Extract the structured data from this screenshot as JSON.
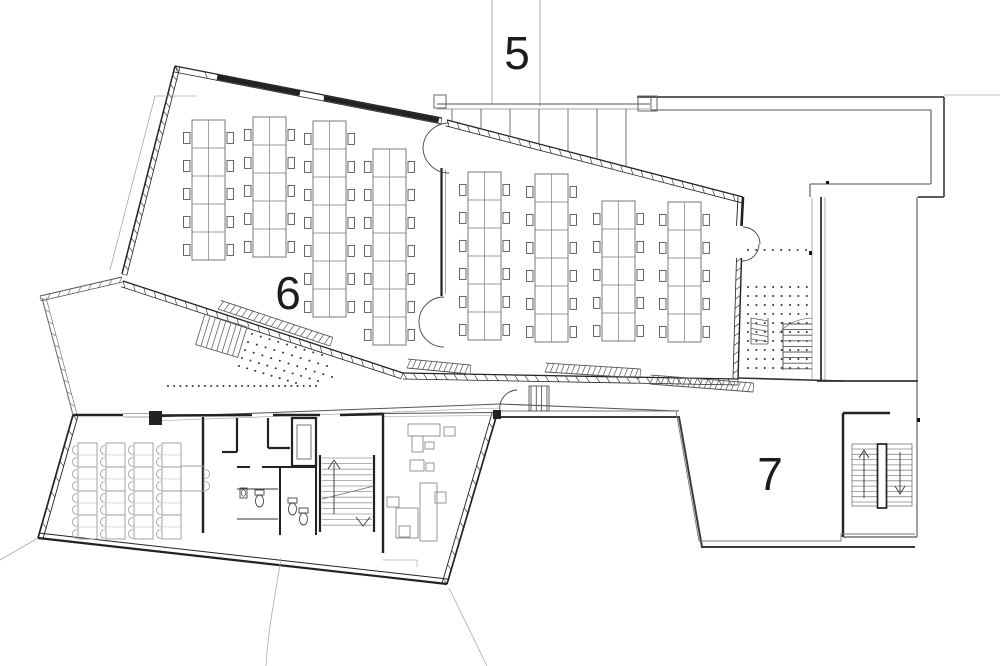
{
  "title": "floor-plan-level",
  "labels": {
    "area_5": "5",
    "area_6": "6",
    "area_7": "7"
  },
  "palette": {
    "ink": "#222222",
    "mid": "#555555",
    "light": "#999999",
    "furniture": "#7a7a7a",
    "faint": "#aaaaaa",
    "bg": "#ffffff"
  },
  "plan": {
    "grid_lines": [
      {
        "x1": 492,
        "y1": 0,
        "x2": 492,
        "y2": 104,
        "w": 0.8,
        "c": "#999999"
      },
      {
        "x1": 540,
        "y1": 0,
        "x2": 540,
        "y2": 107,
        "w": 0.8,
        "c": "#999999"
      }
    ],
    "walls": [
      {
        "x1": 175,
        "y1": 66,
        "x2": 122,
        "y2": 274,
        "off": 5,
        "lw": 1.5,
        "lt": 0.8,
        "hatch": 24,
        "c": "#222222"
      },
      {
        "x1": 175,
        "y1": 66,
        "x2": 442,
        "y2": 118,
        "off": -6,
        "lw": 1.2,
        "lt": 0.8,
        "hatch": 10,
        "solid": [
          [
            0.16,
            0.47
          ],
          [
            0.56,
            0.99
          ]
        ],
        "c": "#222222"
      },
      {
        "x1": 447,
        "y1": 120,
        "x2": 743,
        "y2": 197,
        "off": -6,
        "lw": 1.3,
        "lt": 0.8,
        "hatch": 30,
        "c": "#222222"
      },
      {
        "x1": 743,
        "y1": 197,
        "x2": 741.5,
        "y2": 226,
        "off": -5,
        "lw": 2.6,
        "lt": 0.9,
        "hatch": 0,
        "c": "#222222"
      },
      {
        "x1": 741.5,
        "y1": 258,
        "x2": 738,
        "y2": 379,
        "off": -5,
        "lw": 1.4,
        "lt": 0.8,
        "hatch": 14,
        "c": "#222222"
      },
      {
        "x1": 123,
        "y1": 281,
        "x2": 403,
        "y2": 373,
        "off": -6,
        "lw": 1.3,
        "lt": 0.8,
        "hatch": 28,
        "c": "#222222"
      },
      {
        "x1": 403,
        "y1": 373,
        "x2": 738,
        "y2": 379,
        "off": -6,
        "lw": 1.3,
        "lt": 0.8,
        "hatch": 34,
        "c": "#222222"
      },
      {
        "x1": 122,
        "y1": 277,
        "x2": 40,
        "y2": 296,
        "off": 5,
        "lw": 1.1,
        "lt": 0.7,
        "hatch": 9,
        "c": "#555555"
      },
      {
        "x1": 42,
        "y1": 298,
        "x2": 73,
        "y2": 415,
        "off": 4,
        "lw": 1.0,
        "lt": 0.6,
        "hatch": 11,
        "c": "#666666"
      },
      {
        "x1": 73,
        "y1": 415,
        "x2": 38,
        "y2": 538,
        "off": 5,
        "lw": 1.7,
        "lt": 0.9,
        "hatch": 9,
        "c": "#222222"
      },
      {
        "x1": 38,
        "y1": 538,
        "x2": 447,
        "y2": 584,
        "off": 5,
        "lw": 2.2,
        "lt": 1.0,
        "hatch": 0,
        "c": "#222222"
      },
      {
        "x1": 447,
        "y1": 584,
        "x2": 497,
        "y2": 414,
        "off": 5,
        "lw": 1.7,
        "lt": 0.9,
        "hatch": 13,
        "c": "#222222"
      }
    ],
    "lines": [
      {
        "x1": 437,
        "y1": 104,
        "x2": 650,
        "y2": 104,
        "w": 1.1,
        "c": "#555555"
      },
      {
        "x1": 437,
        "y1": 109,
        "x2": 650,
        "y2": 109,
        "w": 0.7,
        "c": "#888888"
      },
      {
        "x1": 637,
        "y1": 97,
        "x2": 944,
        "y2": 97,
        "w": 1.7,
        "c": "#444444"
      },
      {
        "x1": 944,
        "y1": 97,
        "x2": 944,
        "y2": 197,
        "w": 1.7,
        "c": "#444444"
      },
      {
        "x1": 944,
        "y1": 197,
        "x2": 918,
        "y2": 197,
        "w": 1.7,
        "c": "#444444"
      },
      {
        "x1": 651,
        "y1": 110,
        "x2": 931,
        "y2": 110,
        "w": 1.1,
        "c": "#555555"
      },
      {
        "x1": 931,
        "y1": 110,
        "x2": 931,
        "y2": 184,
        "w": 1.1,
        "c": "#555555"
      },
      {
        "x1": 931,
        "y1": 184,
        "x2": 810,
        "y2": 184,
        "w": 1.1,
        "c": "#555555"
      },
      {
        "x1": 810,
        "y1": 184,
        "x2": 810,
        "y2": 197,
        "w": 1.1,
        "c": "#555555"
      },
      {
        "x1": 651,
        "y1": 97,
        "x2": 651,
        "y2": 110,
        "w": 1.0,
        "c": "#666666"
      },
      {
        "x1": 944,
        "y1": 95,
        "x2": 1000,
        "y2": 95,
        "w": 0.8,
        "c": "#aaaaaa"
      },
      {
        "x1": 821,
        "y1": 197,
        "x2": 821,
        "y2": 381,
        "w": 1.8,
        "c": "#333333"
      },
      {
        "x1": 825,
        "y1": 197,
        "x2": 825,
        "y2": 381,
        "w": 0.7,
        "c": "#888888"
      },
      {
        "x1": 917,
        "y1": 197,
        "x2": 917,
        "y2": 537,
        "w": 1.1,
        "c": "#555555"
      },
      {
        "x1": 817,
        "y1": 381,
        "x2": 918,
        "y2": 381,
        "w": 1.8,
        "c": "#333333"
      },
      {
        "x1": 812,
        "y1": 198,
        "x2": 812,
        "y2": 379,
        "w": 0.8,
        "c": "#999999"
      },
      {
        "x1": 738,
        "y1": 378,
        "x2": 843,
        "y2": 381,
        "w": 1.6,
        "c": "#333333"
      },
      {
        "x1": 152,
        "y1": 417,
        "x2": 500,
        "y2": 404,
        "w": 1.0,
        "c": "#555555"
      },
      {
        "x1": 152,
        "y1": 421,
        "x2": 500,
        "y2": 408,
        "w": 0.6,
        "c": "#999999"
      },
      {
        "x1": 500,
        "y1": 404,
        "x2": 679,
        "y2": 411,
        "w": 1.0,
        "c": "#555555"
      },
      {
        "x1": 155,
        "y1": 96,
        "x2": 197,
        "y2": 96,
        "w": 0.8,
        "c": "#aaaaaa"
      },
      {
        "x1": 155,
        "y1": 96,
        "x2": 110,
        "y2": 270,
        "w": 0.8,
        "c": "#aaaaaa"
      },
      {
        "x1": 38,
        "y1": 538,
        "x2": 0,
        "y2": 560,
        "w": 0.8,
        "c": "#aaaaaa"
      },
      {
        "x1": 449,
        "y1": 588,
        "x2": 487,
        "y2": 666,
        "w": 0.8,
        "c": "#aaaaaa"
      },
      {
        "x1": 441.5,
        "y1": 168,
        "x2": 441.5,
        "y2": 296,
        "w": 2.2,
        "c": "#222222"
      },
      {
        "x1": 445.5,
        "y1": 170,
        "x2": 445.5,
        "y2": 294,
        "w": 0.8,
        "c": "#888888"
      },
      {
        "x1": 73,
        "y1": 415,
        "x2": 123,
        "y2": 415,
        "w": 2.6,
        "c": "#222222"
      },
      {
        "x1": 123,
        "y1": 413.5,
        "x2": 152,
        "y2": 413.5,
        "w": 0.7,
        "c": "#888888"
      },
      {
        "x1": 123,
        "y1": 417,
        "x2": 152,
        "y2": 417,
        "w": 0.7,
        "c": "#888888"
      },
      {
        "x1": 162,
        "y1": 415.5,
        "x2": 252,
        "y2": 415,
        "w": 2.6,
        "c": "#222222"
      },
      {
        "x1": 273,
        "y1": 415,
        "x2": 320,
        "y2": 415,
        "w": 2.6,
        "c": "#222222"
      },
      {
        "x1": 340,
        "y1": 415,
        "x2": 383,
        "y2": 414,
        "w": 2.6,
        "c": "#222222"
      },
      {
        "x1": 383,
        "y1": 413.5,
        "x2": 497,
        "y2": 412.5,
        "w": 0.9,
        "c": "#555555"
      },
      {
        "x1": 383,
        "y1": 416.5,
        "x2": 497,
        "y2": 415.5,
        "w": 0.6,
        "c": "#999999"
      },
      {
        "x1": 203,
        "y1": 417,
        "x2": 203,
        "y2": 533,
        "w": 2.4,
        "c": "#222222"
      },
      {
        "x1": 237,
        "y1": 418,
        "x2": 237,
        "y2": 452,
        "w": 2.2,
        "c": "#222222"
      },
      {
        "x1": 222,
        "y1": 452,
        "x2": 237,
        "y2": 452,
        "w": 2.2,
        "c": "#222222"
      },
      {
        "x1": 268,
        "y1": 418,
        "x2": 268,
        "y2": 448,
        "w": 2.2,
        "c": "#222222"
      },
      {
        "x1": 268,
        "y1": 448,
        "x2": 290,
        "y2": 448,
        "w": 2.2,
        "c": "#222222"
      },
      {
        "x1": 280,
        "y1": 467,
        "x2": 280,
        "y2": 535,
        "w": 2.0,
        "c": "#222222"
      },
      {
        "x1": 316,
        "y1": 467,
        "x2": 316,
        "y2": 535,
        "w": 2.0,
        "c": "#222222"
      },
      {
        "x1": 237,
        "y1": 467,
        "x2": 250,
        "y2": 467,
        "w": 2.0,
        "c": "#222222"
      },
      {
        "x1": 262,
        "y1": 467,
        "x2": 316,
        "y2": 467,
        "w": 2.0,
        "c": "#222222"
      },
      {
        "x1": 237,
        "y1": 489,
        "x2": 278,
        "y2": 489,
        "w": 1.1,
        "c": "#333333"
      },
      {
        "x1": 237,
        "y1": 519,
        "x2": 278,
        "y2": 519,
        "w": 1.1,
        "c": "#333333"
      },
      {
        "x1": 383,
        "y1": 413,
        "x2": 383,
        "y2": 553,
        "w": 2.4,
        "c": "#222222"
      },
      {
        "x1": 843,
        "y1": 413,
        "x2": 890,
        "y2": 413,
        "w": 2.4,
        "c": "#222222"
      },
      {
        "x1": 843,
        "y1": 413,
        "x2": 843,
        "y2": 537,
        "w": 2.4,
        "c": "#222222"
      },
      {
        "x1": 843,
        "y1": 537,
        "x2": 917,
        "y2": 537,
        "w": 1.2,
        "c": "#555555"
      },
      {
        "x1": 320,
        "y1": 455,
        "x2": 320,
        "y2": 532,
        "w": 2.2,
        "c": "#222222"
      },
      {
        "x1": 374,
        "y1": 455,
        "x2": 374,
        "y2": 532,
        "w": 2.2,
        "c": "#222222"
      },
      {
        "x1": 322,
        "y1": 499,
        "x2": 374,
        "y2": 486,
        "w": 0.8,
        "c": "#666666"
      },
      {
        "x1": 383,
        "y1": 560,
        "x2": 417,
        "y2": 560,
        "w": 0.7,
        "c": "#aaaaaa"
      },
      {
        "x1": 417,
        "y1": 560,
        "x2": 417,
        "y2": 567,
        "w": 0.7,
        "c": "#aaaaaa"
      }
    ],
    "paths": [
      {
        "d": "M 449,123 A 26 26 0 0 0 423,149",
        "w": 0.9,
        "c": "#444444"
      },
      {
        "d": "M 449,173 A 26 26 0 0 1 423,147",
        "w": 0.9,
        "c": "#444444"
      },
      {
        "d": "M 444,297 A 25 25 0 0 0 419,322",
        "w": 0.9,
        "c": "#444444"
      },
      {
        "d": "M 444,347 A 25 25 0 0 1 419,322",
        "w": 0.9,
        "c": "#444444"
      },
      {
        "d": "M 743,227 A 17 17 0 0 1 760,244",
        "w": 0.9,
        "c": "#444444"
      },
      {
        "d": "M 742,261 A 17 17 0 0 0 759,244",
        "w": 0.9,
        "c": "#444444"
      },
      {
        "d": "M 517,390 A 18 18 0 0 0 500,411",
        "w": 0.9,
        "c": "#444444"
      },
      {
        "d": "M 281,558 C 276,592 268,628 266,666",
        "w": 0.8,
        "c": "#aaaaaa"
      },
      {
        "d": "M 812,318 Q 791,319 779,333",
        "w": 0.8,
        "c": "#777777"
      }
    ],
    "rects": [
      {
        "x": 434,
        "y": 95,
        "w": 12,
        "h": 13,
        "lw": 1.0,
        "c": "#666666"
      },
      {
        "x": 638,
        "y": 96,
        "w": 19,
        "h": 15,
        "lw": 1.0,
        "c": "#666666"
      },
      {
        "x": 292,
        "y": 418,
        "w": 24,
        "h": 48,
        "lw": 2.2,
        "c": "#222222"
      },
      {
        "x": 297,
        "y": 425,
        "w": 14,
        "h": 34,
        "lw": 0.9,
        "c": "#666666"
      },
      {
        "x": 852,
        "y": 444,
        "w": 60,
        "h": 62,
        "lw": 0.8,
        "c": "#777777"
      },
      {
        "x": 877.5,
        "y": 444,
        "w": 9,
        "h": 64,
        "lw": 1.7,
        "c": "#222222",
        "fill": "#ffffff"
      },
      {
        "x": 529,
        "y": 386,
        "w": 20,
        "h": 25,
        "lw": 0.9,
        "c": "#555555"
      }
    ],
    "solid_rects": [
      {
        "x": 149,
        "y": 411,
        "w": 13,
        "h": 14,
        "c": "#222222"
      },
      {
        "x": 493,
        "y": 410,
        "w": 8,
        "h": 9,
        "c": "#222222"
      },
      {
        "x": 826,
        "y": 181,
        "w": 3,
        "h": 3,
        "c": "#111111"
      },
      {
        "x": 809,
        "y": 251,
        "w": 3,
        "h": 4,
        "c": "#111111"
      },
      {
        "x": 917,
        "y": 418,
        "w": 3,
        "h": 4,
        "c": "#111111"
      }
    ],
    "hatch_bands": [
      {
        "x1": 218,
        "y1": 309,
        "x2": 330,
        "y2": 346,
        "w": 9,
        "n": 20
      },
      {
        "x1": 407,
        "y1": 368,
        "x2": 470,
        "y2": 374,
        "w": 9,
        "n": 13
      },
      {
        "x1": 545,
        "y1": 372,
        "x2": 640,
        "y2": 378,
        "w": 9,
        "n": 19
      },
      {
        "x1": 650,
        "y1": 384,
        "x2": 753,
        "y2": 392,
        "w": 9,
        "n": 20
      },
      {
        "x1": 751,
        "y1": 318,
        "x2": 751,
        "y2": 344,
        "w": 17,
        "n": 6
      }
    ],
    "dot_rows": [
      {
        "x1": 168,
        "y1": 386,
        "x2": 316,
        "y2": 386,
        "n": 25
      },
      {
        "x1": 252,
        "y1": 334,
        "x2": 322,
        "y2": 355,
        "n": 9
      },
      {
        "x1": 248,
        "y1": 342,
        "x2": 327,
        "y2": 366,
        "n": 10
      },
      {
        "x1": 245,
        "y1": 350,
        "x2": 332,
        "y2": 377,
        "n": 11
      },
      {
        "x1": 242,
        "y1": 358,
        "x2": 318,
        "y2": 381,
        "n": 10
      },
      {
        "x1": 239,
        "y1": 366,
        "x2": 296,
        "y2": 383,
        "n": 8
      },
      {
        "x1": 748,
        "y1": 250,
        "x2": 806,
        "y2": 250,
        "n": 8
      }
    ],
    "dot_grids": [
      {
        "x": 748,
        "y": 287,
        "dx": 8.4,
        "dy": 9,
        "nx": 8,
        "ny": 10
      }
    ],
    "mullions": {
      "y_top": 109,
      "xs": [
        452,
        481,
        510,
        539,
        568,
        597,
        626
      ],
      "x0": 447,
      "y0": 120,
      "slope": 0.26
    },
    "terrace7": {
      "outer": "497,417 679,417 702,547 915,547",
      "inner": "497,411 676,411 699,541 841,541 841,534 915,534",
      "ow": 2.0,
      "iw": 0.9,
      "oc": "#3a3a3a",
      "ic": "#777777"
    },
    "big_desks": {
      "tw": 33,
      "seg": 28,
      "stroke": "#7a7a7a",
      "chair_stroke": "#555555",
      "cols": [
        {
          "x": 192,
          "y": 120,
          "n": 5
        },
        {
          "x": 253,
          "y": 117,
          "n": 5
        },
        {
          "x": 313,
          "y": 121,
          "n": 7
        },
        {
          "x": 373,
          "y": 149,
          "n": 7
        },
        {
          "x": 468,
          "y": 172,
          "n": 6
        },
        {
          "x": 535,
          "y": 174,
          "n": 6
        },
        {
          "x": 602,
          "y": 201,
          "n": 5
        },
        {
          "x": 668,
          "y": 202,
          "n": 5
        }
      ]
    },
    "lower_desks": {
      "tw": 19,
      "seg": 24,
      "stroke": "#9a9a9a",
      "sub": "#bbbbbb",
      "cols": [
        {
          "x": 78,
          "y": 443,
          "n": 4
        },
        {
          "x": 106,
          "y": 443,
          "n": 4
        },
        {
          "x": 134,
          "y": 443,
          "n": 4
        },
        {
          "x": 162,
          "y": 443,
          "n": 4
        }
      ],
      "extra_table": {
        "x": 181,
        "y": 466,
        "w": 23,
        "h": 25
      },
      "extra_chairs": [
        {
          "x": 205,
          "y": 474
        },
        {
          "x": 205,
          "y": 486
        }
      ]
    },
    "office_rects": [
      {
        "x": 408,
        "y": 424,
        "w": 32,
        "h": 12
      },
      {
        "x": 412,
        "y": 436,
        "w": 11,
        "h": 16
      },
      {
        "x": 444,
        "y": 427,
        "w": 11,
        "h": 9
      },
      {
        "x": 425,
        "y": 442,
        "w": 9,
        "h": 7
      },
      {
        "x": 410,
        "y": 460,
        "w": 14,
        "h": 11
      },
      {
        "x": 426,
        "y": 463,
        "w": 8,
        "h": 8
      },
      {
        "x": 420,
        "y": 483,
        "w": 17,
        "h": 58
      },
      {
        "x": 435,
        "y": 492,
        "w": 11,
        "h": 11
      },
      {
        "x": 396,
        "y": 508,
        "w": 22,
        "h": 30
      },
      {
        "x": 399,
        "y": 526,
        "w": 11,
        "h": 11
      },
      {
        "x": 387,
        "y": 497,
        "w": 12,
        "h": 10
      }
    ],
    "toilets": [
      {
        "x": 255,
        "y": 490
      },
      {
        "x": 288,
        "y": 498
      },
      {
        "x": 299,
        "y": 508
      }
    ],
    "sinks": [
      {
        "x": 240,
        "y": 488
      }
    ],
    "stairs": {
      "main": {
        "x": 322,
        "x2": 372,
        "y0": 458,
        "step": 5.6,
        "n": 13,
        "c": "#999999"
      },
      "right_a": {
        "x": 852,
        "x2": 877,
        "y0": 449,
        "step": 5.3,
        "n": 11,
        "c": "#888888"
      },
      "right_b": {
        "x": 887,
        "x2": 912,
        "y0": 449,
        "step": 5.3,
        "n": 11,
        "c": "#888888"
      },
      "terrace": {
        "x": 783,
        "x2": 812,
        "y0": 324,
        "step": 5.6,
        "n": 9,
        "c": "#555555",
        "edge": {
          "x1": 783,
          "y1": 322,
          "x2": 783,
          "y2": 370
        }
      },
      "entry": {
        "y": 386,
        "y2": 411,
        "x0": 531,
        "step": 5.3,
        "n": 4,
        "c": "#555555"
      },
      "exterior": {
        "tx": 205,
        "ty": 314,
        "rot": 17,
        "w": 44,
        "h": 32,
        "step": 5.5,
        "c": "#666666"
      }
    },
    "arrows": [
      {
        "shaft": [
          334,
          514,
          334,
          463
        ],
        "head": "M 328,469 L 334,460 L 340,469"
      },
      {
        "head": "M 356,517 L 363,526 L 370,517"
      },
      {
        "shaft": [
          864,
          498,
          864,
          452
        ],
        "head": "M 859,458 L 864,450 L 869,458"
      },
      {
        "shaft": [
          900,
          452,
          900,
          492
        ],
        "head": "M 895,486 L 900,494 L 905,486"
      }
    ]
  }
}
